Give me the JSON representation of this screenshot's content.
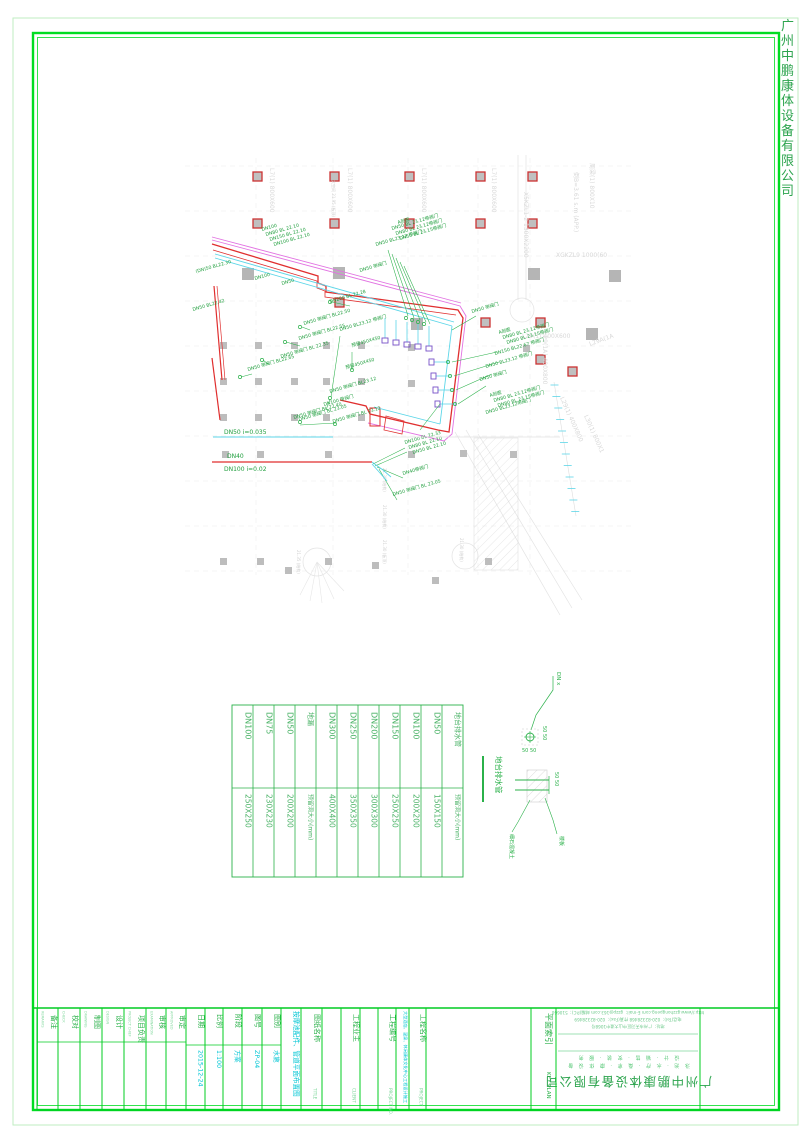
{
  "colors": {
    "frame_green": "#00dd22",
    "outer_border": "#bfeec2",
    "label_green": "#2bb14a",
    "anno_green": "#1f9e3d",
    "value_cyan": "#00c6d4",
    "pipe_red": "#e02f2f",
    "pipe_magenta": "#e273e2",
    "pipe_cyan": "#5cd6e8",
    "jet_purple": "#7752c8",
    "faint_gray": "#d9d9d9",
    "column_gray": "#b5b5b5"
  },
  "margin": {
    "company_vertical": "广州中鹏康体设备有限公司"
  },
  "plan": {
    "pipe_labels": {
      "dn50": "DN50 i=0.035",
      "dn40": "DN40",
      "dn100": "DN100 i=0.02"
    },
    "beam_labels": [
      {
        "t": "L7(1) 800X600",
        "x": 270,
        "y": 168,
        "r": 90
      },
      {
        "t": "L7(1) 800X600",
        "x": 348,
        "y": 168,
        "r": 90
      },
      {
        "t": "L7(1) 800X600",
        "x": 422,
        "y": 168,
        "r": 90
      },
      {
        "t": "L7(1) 800X600",
        "x": 492,
        "y": 168,
        "r": 90
      },
      {
        "t": "X5KZL1-2 1300X2200",
        "x": 524,
        "y": 192,
        "r": 90
      },
      {
        "t": "倒B=3.61 s.m (APP.)",
        "x": 574,
        "y": 172,
        "r": 90
      },
      {
        "t": "周梁(1) 800X10",
        "x": 590,
        "y": 163,
        "r": 90
      },
      {
        "t": "XGKZL9 1000(60",
        "x": 556,
        "y": 257,
        "r": 0
      },
      {
        "t": "L29(1A) 400X800",
        "x": 543,
        "y": 332,
        "r": 90
      },
      {
        "t": "L29(1) 400X600",
        "x": 522,
        "y": 338,
        "r": 0
      },
      {
        "t": "L29(1) 400X800",
        "x": 560,
        "y": 398,
        "r": 66
      },
      {
        "t": "L30(1) 800X1",
        "x": 584,
        "y": 416,
        "r": 66
      },
      {
        "t": "L29A(1A",
        "x": 590,
        "y": 346,
        "r": -20
      }
    ],
    "dim_labels": [
      {
        "t": "大空间 21.95 (板顶)",
        "x": 332,
        "y": 180
      },
      {
        "t": "21.30 (结构)",
        "x": 383,
        "y": 468
      },
      {
        "t": "21.30 (结构)",
        "x": 383,
        "y": 505
      },
      {
        "t": "21.30 (板顶)",
        "x": 383,
        "y": 540
      },
      {
        "t": "21.35 (结构)",
        "x": 297,
        "y": 550
      },
      {
        "t": "21.30 (结构)",
        "x": 460,
        "y": 538
      }
    ],
    "annotations": [
      {
        "t": "DN100",
        "x": 262,
        "y": 231
      },
      {
        "t": "DN80 BL 22.10",
        "x": 266,
        "y": 236
      },
      {
        "t": "DN150 BL 22.10",
        "x": 270,
        "y": 241
      },
      {
        "t": "DN100 BL 22.10",
        "x": 274,
        "y": 246
      },
      {
        "t": "A剖面",
        "x": 398,
        "y": 224
      },
      {
        "t": "DN50 BL 23.12带阀门",
        "x": 392,
        "y": 230
      },
      {
        "t": "DN80 BL 23.12带阀门",
        "x": 396,
        "y": 235
      },
      {
        "t": "DN50 BL 23.15带阀门",
        "x": 400,
        "y": 240
      },
      {
        "t": "DN50 BL23.12 带阀门",
        "x": 376,
        "y": 246
      },
      {
        "t": "DN50 带阀门",
        "x": 360,
        "y": 272
      },
      {
        "t": "(DN)50 BL22.30",
        "x": 196,
        "y": 273
      },
      {
        "t": "DN100",
        "x": 255,
        "y": 280
      },
      {
        "t": "DN50",
        "x": 282,
        "y": 285
      },
      {
        "t": "DN200 BL 22.28",
        "x": 330,
        "y": 303
      },
      {
        "t": "DN50 BL22.42",
        "x": 193,
        "y": 311
      },
      {
        "t": "DN50 带阀门 BL22.50",
        "x": 304,
        "y": 325
      },
      {
        "t": "DN50 BL23.12 带阀门",
        "x": 340,
        "y": 331
      },
      {
        "t": "DN50 带阀门 BL22.55",
        "x": 299,
        "y": 340
      },
      {
        "t": "预留450X450",
        "x": 352,
        "y": 347
      },
      {
        "t": "DN50 带阀门 BL 22.35",
        "x": 281,
        "y": 358
      },
      {
        "t": "预留450X450",
        "x": 346,
        "y": 369
      },
      {
        "t": "DN50 带阀门 BL22.65",
        "x": 248,
        "y": 371
      },
      {
        "t": "DN50 带阀门 BL23.12",
        "x": 330,
        "y": 393
      },
      {
        "t": "DN100 带阀门",
        "x": 324,
        "y": 406
      },
      {
        "t": "DN50 带阀门 BL 22.40",
        "x": 294,
        "y": 419
      },
      {
        "t": "DN50 带阀门 BL 23.05",
        "x": 299,
        "y": 421
      },
      {
        "t": "DN50 带阀门 BL 23.12",
        "x": 333,
        "y": 423
      },
      {
        "t": "DN50 带阀门",
        "x": 472,
        "y": 313
      },
      {
        "t": "A剖面",
        "x": 499,
        "y": 334
      },
      {
        "t": "DN80 BL 23.12带阀门",
        "x": 503,
        "y": 339
      },
      {
        "t": "DN80 BL 23.15带阀门",
        "x": 507,
        "y": 344
      },
      {
        "t": "DN150 BL22.67 带阀门",
        "x": 495,
        "y": 355
      },
      {
        "t": "DN50 BL23.12 带阀门",
        "x": 486,
        "y": 368
      },
      {
        "t": "DN50 带阀门",
        "x": 480,
        "y": 381
      },
      {
        "t": "A剖面",
        "x": 490,
        "y": 397
      },
      {
        "t": "DN80 BL 23.12带阀门",
        "x": 494,
        "y": 402
      },
      {
        "t": "DN80 BL 23.15带阀门",
        "x": 498,
        "y": 407
      },
      {
        "t": "DN50 BL23.12带阀门",
        "x": 486,
        "y": 414
      },
      {
        "t": "DN100 BL 22.33",
        "x": 405,
        "y": 444
      },
      {
        "t": "DN80 BL 22.10",
        "x": 409,
        "y": 449
      },
      {
        "t": "DN50 BL 22.10",
        "x": 413,
        "y": 454
      },
      {
        "t": "DN40带阀门",
        "x": 403,
        "y": 475
      },
      {
        "t": "DN50 带阀门 BL 23.05",
        "x": 393,
        "y": 496
      }
    ]
  },
  "table": {
    "columns": [
      {
        "top": "DN100",
        "bottom": "250X250"
      },
      {
        "top": "DN75",
        "bottom": "230X230"
      },
      {
        "top": "DN50",
        "bottom": "200X200"
      },
      {
        "top": "地漏",
        "bottom": "预留洞大小(mm)"
      },
      {
        "top": "DN300",
        "bottom": "400X400"
      },
      {
        "top": "DN250",
        "bottom": "350X350"
      },
      {
        "top": "DN200",
        "bottom": "300X300"
      },
      {
        "top": "DN150",
        "bottom": "250X250"
      },
      {
        "top": "DN100",
        "bottom": "200X200"
      },
      {
        "top": "DN50",
        "bottom": "150X150"
      },
      {
        "top": "地台排水管",
        "bottom": "预留洞大小(mm)"
      }
    ]
  },
  "detail": {
    "title": "地台排水管",
    "dn": "DN x",
    "dim1": "50 50",
    "dim2": "50 50",
    "dim3": "50 50",
    "mat": "细石混凝土",
    "slab": "楼板"
  },
  "titleblock": {
    "sig_cols": [
      {
        "label": "备注",
        "en": "REMARKS"
      },
      {
        "label": "校对",
        "en": "CHECK"
      },
      {
        "label": "制图",
        "en": "DRAWING"
      },
      {
        "label": "设计",
        "en": "DESIGN"
      },
      {
        "label": "项目负责",
        "en": "PROJECT CHIEF"
      },
      {
        "label": "审核",
        "en": "EXAMINATION"
      },
      {
        "label": "审定",
        "en": "APPROVED"
      }
    ],
    "value_cols": [
      {
        "label": "日期",
        "value": "2015-12-24"
      },
      {
        "label": "比例",
        "value": "1:100"
      },
      {
        "label": "阶段",
        "value": "方案"
      },
      {
        "label": "图号",
        "value": "ZP-04"
      },
      {
        "label": "图别",
        "value": "水施"
      }
    ],
    "drawing_title": "按摩池配件、管道平面布置图",
    "title_label": "图纸名称",
    "title_en": "TITLE",
    "client_label": "工程业主",
    "client_en": "CLIENT",
    "projno_label": "工程编号",
    "projno_en": "PROJECT NO.",
    "project_value": "大型酒店、温泉、休闲康体文化中心工程设计施工",
    "project_label": "工程名称",
    "project_en": "PROJECT",
    "keyplan_label": "平面索引",
    "keyplan_en": "KEY PLAN",
    "company": {
      "name": "广州中鹏康体设备有限公司",
      "scope1": "泳 池 · 水 疗 · 桑 拿 · 康 体 设 备",
      "scope2": "设 计 · 销 售 · 安 装 · 服 务",
      "addr": "地址：广州市天河区中山大道中1068号",
      "tel": "电话(Tel)：020-82328468  传真(Fax)：020-82328469",
      "web": "http://www.gzzhongpeng.com  E-mail：gzzp@163.com  邮编(P.C)：510660"
    }
  }
}
